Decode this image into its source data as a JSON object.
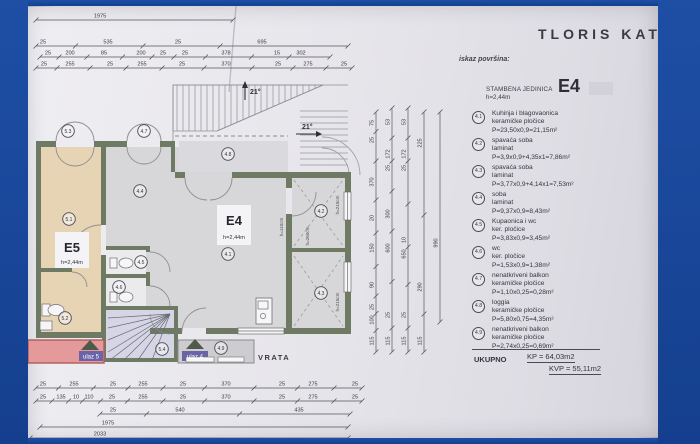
{
  "document": {
    "title": "TLORIS  KATA",
    "legend": {
      "heading": "iskaz površina:",
      "unit": {
        "label": "STAMBENA JEDINICA",
        "height": "h=2,44m",
        "code": "E4"
      },
      "items": [
        {
          "code": "4.1",
          "name": "Kuhinja i blagovaonica",
          "material": "keramičke pločice",
          "area": "P=23,50x0,9=21,15m²"
        },
        {
          "code": "4.2",
          "name": "spavaća soba",
          "material": "laminat",
          "area": "P=3,9x0,9+4,35x1=7,86m²"
        },
        {
          "code": "4.3",
          "name": "spavaća soba",
          "material": "laminat",
          "area": "P=3,77x0,9+4,14x1=7,53m²"
        },
        {
          "code": "4.4",
          "name": "soba",
          "material": "laminat",
          "area": "P=9,37x0,9=8,43m²"
        },
        {
          "code": "4.5",
          "name": "Kupaonica i wc",
          "material": "ker. pločice",
          "area": "P=3,83x0,9=3,45m²"
        },
        {
          "code": "4.6",
          "name": "wc",
          "material": "ker. pločice",
          "area": "P=1,53x0,9=1,38m²"
        },
        {
          "code": "4.7",
          "name": "nenatkriveni balkon",
          "material": "keramičke pločice",
          "area": "P=1,10x0,25=0,28m²"
        },
        {
          "code": "4.8",
          "name": "loggia",
          "material": "keramičke pločice",
          "area": "P=5,80x0,75=4,35m²"
        },
        {
          "code": "4.9",
          "name": "nenatkriveni balkon",
          "material": "keramičke pločice",
          "area": "P=2,74x0,25=0,69m²"
        }
      ],
      "totals": {
        "label": "UKUPNO",
        "kp": "KP = 64,03m2",
        "kvp": "KVP = 55,11m2"
      }
    },
    "plan": {
      "units": [
        {
          "code": "E4",
          "height": "h=2,44m"
        },
        {
          "code": "E5",
          "height": "h=2,44m"
        }
      ],
      "door_label": "VRATA",
      "entrances": [
        "ulaz 5",
        "ulaz 4"
      ],
      "slope_angle": "21°",
      "markers": [
        {
          "t": "5.3",
          "x": 68,
          "y": 131
        },
        {
          "t": "4.7",
          "x": 144,
          "y": 131
        },
        {
          "t": "4.8",
          "x": 228,
          "y": 154
        },
        {
          "t": "4.4",
          "x": 140,
          "y": 191
        },
        {
          "t": "5.1",
          "x": 69,
          "y": 219
        },
        {
          "t": "4.2",
          "x": 321,
          "y": 211
        },
        {
          "t": "4.1",
          "x": 228,
          "y": 254
        },
        {
          "t": "4.3",
          "x": 321,
          "y": 293
        },
        {
          "t": "4.5",
          "x": 141,
          "y": 262
        },
        {
          "t": "4.6",
          "x": 119,
          "y": 287
        },
        {
          "t": "5.2",
          "x": 65,
          "y": 318
        },
        {
          "t": "5.4",
          "x": 162,
          "y": 349
        },
        {
          "t": "4.9",
          "x": 221,
          "y": 348
        }
      ],
      "height_labels": [
        {
          "t": "h=110cm",
          "x": 283,
          "y": 227
        },
        {
          "t": "h=260cm",
          "x": 309,
          "y": 236
        },
        {
          "t": "h=215cm",
          "x": 339,
          "y": 205
        },
        {
          "t": "h=215cm",
          "x": 339,
          "y": 302
        }
      ],
      "dims": {
        "top": [
          {
            "y": 20,
            "x0": 36,
            "x1": 233,
            "labels": [
              {
                "x": 100,
                "t": "1975"
              }
            ]
          },
          {
            "y": 46,
            "x0": 36,
            "x1": 348,
            "labels": [
              {
                "x": 43,
                "t": "25"
              },
              {
                "x": 108,
                "t": "535"
              },
              {
                "x": 178,
                "t": "25"
              },
              {
                "x": 262,
                "t": "695"
              }
            ]
          },
          {
            "y": 57,
            "x0": 40,
            "x1": 330,
            "labels": [
              {
                "x": 48,
                "t": "25"
              },
              {
                "x": 70,
                "t": "200"
              },
              {
                "x": 104,
                "t": "85"
              },
              {
                "x": 141,
                "t": "200"
              },
              {
                "x": 163,
                "t": "25"
              },
              {
                "x": 185,
                "t": "25"
              },
              {
                "x": 226,
                "t": "378"
              },
              {
                "x": 277,
                "t": "15"
              },
              {
                "x": 301,
                "t": "302"
              }
            ]
          },
          {
            "y": 68,
            "x0": 36,
            "x1": 352,
            "labels": [
              {
                "x": 44,
                "t": "25"
              },
              {
                "x": 70,
                "t": "255"
              },
              {
                "x": 110,
                "t": "25"
              },
              {
                "x": 142,
                "t": "255"
              },
              {
                "x": 182,
                "t": "25"
              },
              {
                "x": 226,
                "t": "370"
              },
              {
                "x": 278,
                "t": "25"
              },
              {
                "x": 308,
                "t": "275"
              },
              {
                "x": 344,
                "t": "25"
              }
            ]
          }
        ],
        "bottom": [
          {
            "y": 388,
            "x0": 36,
            "x1": 362,
            "labels": [
              {
                "x": 43,
                "t": "25"
              },
              {
                "x": 74,
                "t": "255"
              },
              {
                "x": 113,
                "t": "25"
              },
              {
                "x": 143,
                "t": "255"
              },
              {
                "x": 183,
                "t": "25"
              },
              {
                "x": 226,
                "t": "370"
              },
              {
                "x": 282,
                "t": "25"
              },
              {
                "x": 313,
                "t": "275"
              },
              {
                "x": 355,
                "t": "25"
              }
            ]
          },
          {
            "y": 401,
            "x0": 36,
            "x1": 362,
            "labels": [
              {
                "x": 43,
                "t": "25"
              },
              {
                "x": 61,
                "t": "135"
              },
              {
                "x": 76,
                "t": "10"
              },
              {
                "x": 89,
                "t": "110"
              },
              {
                "x": 112,
                "t": "25"
              },
              {
                "x": 143,
                "t": "255"
              },
              {
                "x": 183,
                "t": "25"
              },
              {
                "x": 226,
                "t": "370"
              },
              {
                "x": 282,
                "t": "25"
              },
              {
                "x": 313,
                "t": "275"
              },
              {
                "x": 355,
                "t": "25"
              }
            ]
          },
          {
            "y": 414,
            "x0": 100,
            "x1": 350,
            "labels": [
              {
                "x": 113,
                "t": "25"
              },
              {
                "x": 180,
                "t": "540"
              },
              {
                "x": 299,
                "t": "435"
              }
            ]
          },
          {
            "y": 427,
            "x0": 40,
            "x1": 348,
            "labels": [
              {
                "x": 108,
                "t": "1975"
              }
            ]
          },
          {
            "y": 438,
            "x0": 30,
            "x1": 348,
            "labels": [
              {
                "x": 100,
                "t": "2033"
              }
            ]
          }
        ],
        "right": [
          {
            "x": 376,
            "y0": 112,
            "y1": 352,
            "labels": [
              {
                "y": 123,
                "t": "75"
              },
              {
                "y": 140,
                "t": "25"
              },
              {
                "y": 182,
                "t": "370"
              },
              {
                "y": 218,
                "t": "20"
              },
              {
                "y": 248,
                "t": "150"
              },
              {
                "y": 285,
                "t": "90"
              },
              {
                "y": 307,
                "t": "25"
              },
              {
                "y": 320,
                "t": "100"
              },
              {
                "y": 341,
                "t": "115"
              }
            ]
          },
          {
            "x": 392,
            "y0": 108,
            "y1": 352,
            "labels": [
              {
                "y": 122,
                "t": "53"
              },
              {
                "y": 154,
                "t": "172"
              },
              {
                "y": 168,
                "t": "25"
              },
              {
                "y": 214,
                "t": "300"
              },
              {
                "y": 248,
                "t": "600"
              },
              {
                "y": 315,
                "t": "25"
              },
              {
                "y": 341,
                "t": "115"
              }
            ]
          },
          {
            "x": 408,
            "y0": 108,
            "y1": 352,
            "labels": [
              {
                "y": 122,
                "t": "53"
              },
              {
                "y": 154,
                "t": "172"
              },
              {
                "y": 168,
                "t": "25"
              },
              {
                "y": 240,
                "t": "10"
              },
              {
                "y": 254,
                "t": "650"
              },
              {
                "y": 315,
                "t": "25"
              },
              {
                "y": 341,
                "t": "115"
              }
            ]
          },
          {
            "x": 424,
            "y0": 112,
            "y1": 352,
            "labels": [
              {
                "y": 143,
                "t": "225"
              },
              {
                "y": 287,
                "t": "290"
              },
              {
                "y": 341,
                "t": "115"
              }
            ]
          },
          {
            "x": 440,
            "y0": 112,
            "y1": 322,
            "labels": [
              {
                "y": 243,
                "t": "990"
              }
            ]
          }
        ]
      }
    },
    "colors": {
      "frame_blue": "#1b4698",
      "paper": "#e7e6eb",
      "wall": "#6f7a64",
      "room_gray": "#d7d7da",
      "room_tan": "#e7d4b5",
      "stairs_lavender": "#d6d5e6",
      "balcony_pink": "#e49a9b",
      "entrance_chip_purple": "#6b63a8"
    }
  }
}
